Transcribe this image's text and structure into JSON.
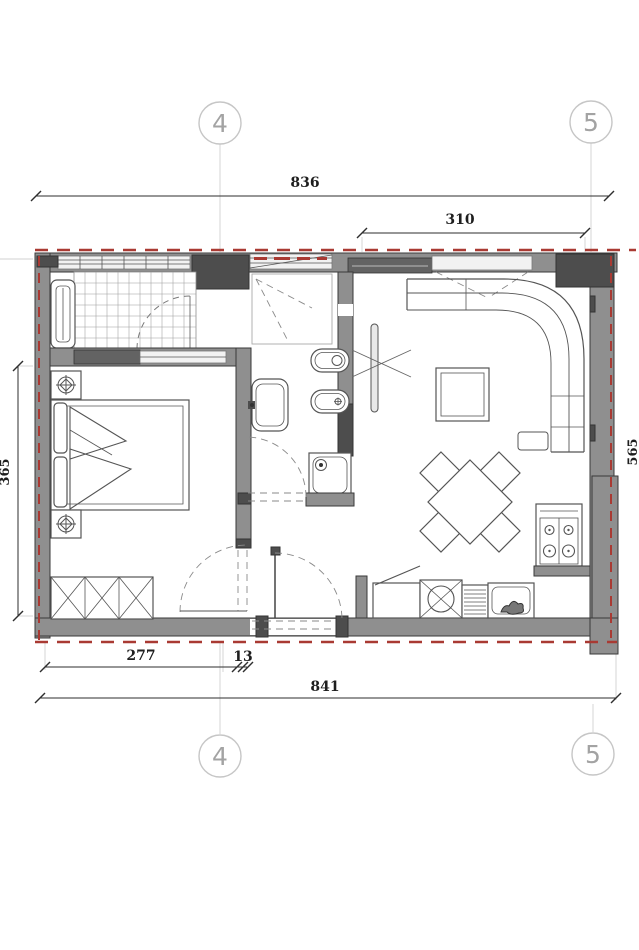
{
  "drawing_type": "apartment floor plan section between grid lines 4 and 5",
  "grid_markers": {
    "top_left": "4",
    "top_right": "5",
    "bottom_left": "4",
    "bottom_right": "5"
  },
  "dims": {
    "top_overall": "836",
    "top_right": "310",
    "left_height": "365",
    "right_height_partial": "565",
    "bottom_left": "277",
    "bottom_gap": "13",
    "bottom_overall": "841"
  },
  "colors": {
    "background": "#ffffff",
    "wall_fill": "#8f8f8f",
    "wall_dark": "#4d4d4d",
    "wall_outline": "#3a3a3a",
    "insulation_dash_red": "#a93a33",
    "dimension_text": "#1e1e1e",
    "grid_marker_gray": "#a3a3a3",
    "furniture_line": "#555555"
  },
  "rooms": {
    "balcony": {
      "fixtures": [
        "radiator",
        "tile floor grid",
        "door swing arc"
      ]
    },
    "bedroom": {
      "fixtures": [
        "double bed",
        "headboard cushions",
        "pillow fan",
        "nightstand top",
        "nightstand bottom",
        "ceiling lamp symbols",
        "wardrobe three sections",
        "door swing arc"
      ]
    },
    "bathroom": {
      "fixtures": [
        "shower area dashed",
        "wash basin",
        "toilet",
        "bidet",
        "shower tray with drain",
        "door swing arc"
      ]
    },
    "hall": {
      "fixtures": [
        "entrance door leaf",
        "entrance door swing arc",
        "threshold dashes"
      ]
    },
    "living_kitchen": {
      "fixtures": [
        "tv on wall",
        "corner sofa",
        "coffee table",
        "dining table",
        "four chairs",
        "stove four burners",
        "kitchen counter",
        "kitchen sink",
        "dishwasher"
      ]
    }
  }
}
